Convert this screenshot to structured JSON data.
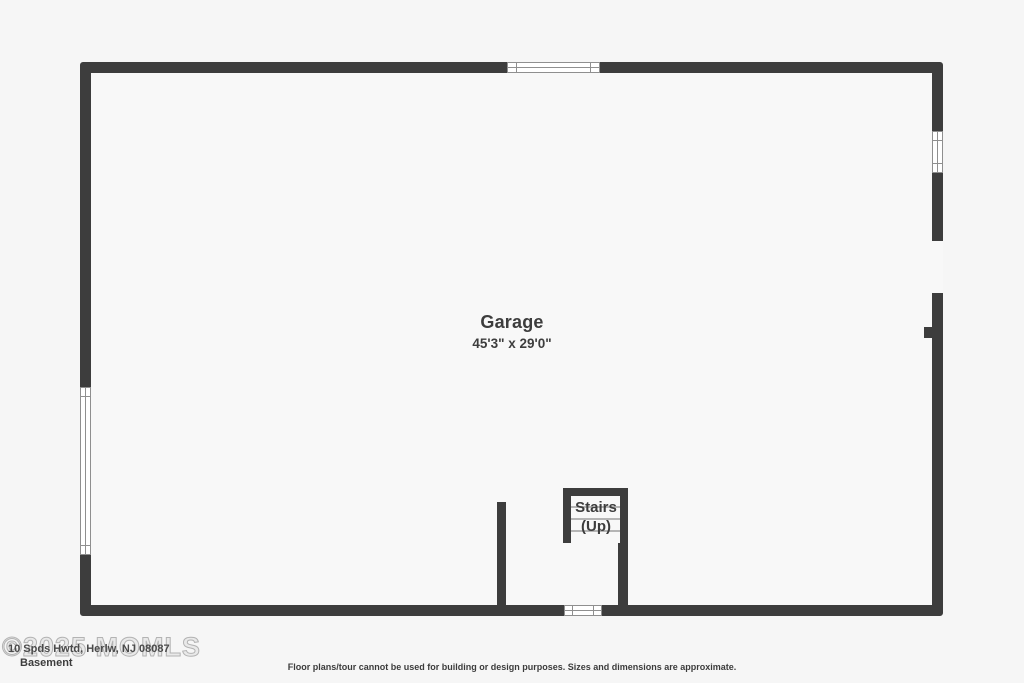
{
  "plan": {
    "room": {
      "name": "Garage",
      "dimensions": "45'3\" x 29'0\""
    },
    "stairs": {
      "label": "Stairs",
      "direction": "(Up)"
    },
    "colors": {
      "wall": "#3d3d3d",
      "floor": "#f8f8f8",
      "background": "#f6f6f6",
      "window_line": "#8f8f8f",
      "tread_line": "#b5b5b5",
      "watermark": "#b3b3b3",
      "text": "#3d3d3d"
    },
    "symbols": [
      "window-symbol",
      "door-opening",
      "wall-stub",
      "stair-treads"
    ]
  },
  "footer": {
    "watermark": "©2025 MOMLS",
    "listing_text": "10 Spds Hwtd, Herlw, NJ 08087",
    "floor_label": "Basement",
    "disclaimer": "Floor plans/tour cannot be used for building or design purposes. Sizes and dimensions are approximate."
  }
}
